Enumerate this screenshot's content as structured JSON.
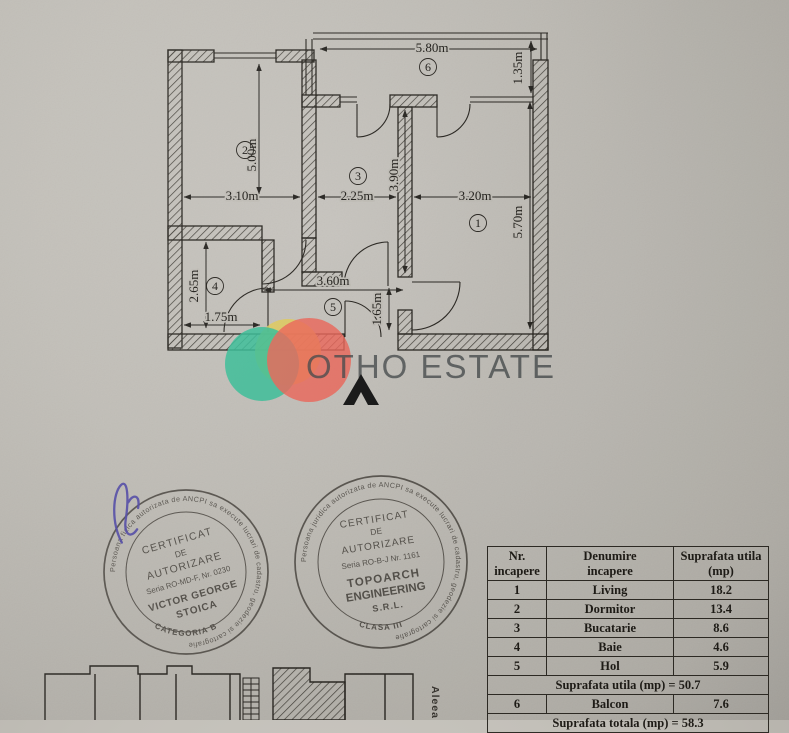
{
  "plan": {
    "room_labels": [
      "1",
      "2",
      "3",
      "4",
      "5",
      "6"
    ],
    "dimensions": {
      "balcony_width": "5.80m",
      "balcony_depth": "1.35m",
      "dormitor_height": "5.00m",
      "dormitor_width": "3.10m",
      "bucatarie_width": "2.25m",
      "bucatarie_height": "3.90m",
      "living_width": "3.20m",
      "living_height": "5.70m",
      "baie_height": "2.65m",
      "baie_width": "1.75m",
      "hol_width": "3.60m",
      "hol_opening": "1.65m"
    }
  },
  "watermark": {
    "brand": "OTHO ESTATE"
  },
  "site_plan": {
    "street": "Aleea Rom"
  },
  "stamps": {
    "left": {
      "line1": "CERTIFICAT",
      "line2": "DE",
      "line3": "AUTORIZARE",
      "line4": "Seria RO-MD-F, Nr. 0230",
      "line5": "VICTOR GEORGE",
      "line6": "STOICA",
      "ring": "Persoana fizica autorizata de ANCPI sa execute lucrari de cadastru, geodezie si cartografie",
      "bottom": "CATEGORIA B"
    },
    "right": {
      "line1": "CERTIFICAT",
      "line2": "DE",
      "line3": "AUTORIZARE",
      "line4": "Seria RO-B-J Nr. 1161",
      "line5": "TOPOARCH",
      "line6": "ENGINEERING",
      "line7": "S.R.L.",
      "ring": "Persoana juridica autorizata de ANCPI sa execute lucrari de cadastru, geodezie si cartografie",
      "bottom": "CLASA III"
    }
  },
  "table": {
    "headers": {
      "col1_line1": "Nr.",
      "col1_line2": "incapere",
      "col2_line1": "Denumire",
      "col2_line2": "incapere",
      "col3_line1": "Suprafata utila",
      "col3_line2": "(mp)"
    },
    "rows": [
      {
        "nr": "1",
        "name": "Living",
        "area": "18.2"
      },
      {
        "nr": "2",
        "name": "Dormitor",
        "area": "13.4"
      },
      {
        "nr": "3",
        "name": "Bucatarie",
        "area": "8.6"
      },
      {
        "nr": "4",
        "name": "Baie",
        "area": "4.6"
      },
      {
        "nr": "5",
        "name": "Hol",
        "area": "5.9"
      }
    ],
    "subtotal": "Suprafata utila (mp) = 50.7",
    "balcony_row": {
      "nr": "6",
      "name": "Balcon",
      "area": "7.6"
    },
    "total": "Suprafata totala (mp) = 58.3"
  },
  "colors": {
    "teal": "#3cc39c",
    "yellow": "#e5cf5e",
    "red": "#f1695c",
    "ink": "#2a2824",
    "paper": "#c2bfb8",
    "stamp_ink": "#514d48",
    "signature_blue": "#4d45a8"
  }
}
